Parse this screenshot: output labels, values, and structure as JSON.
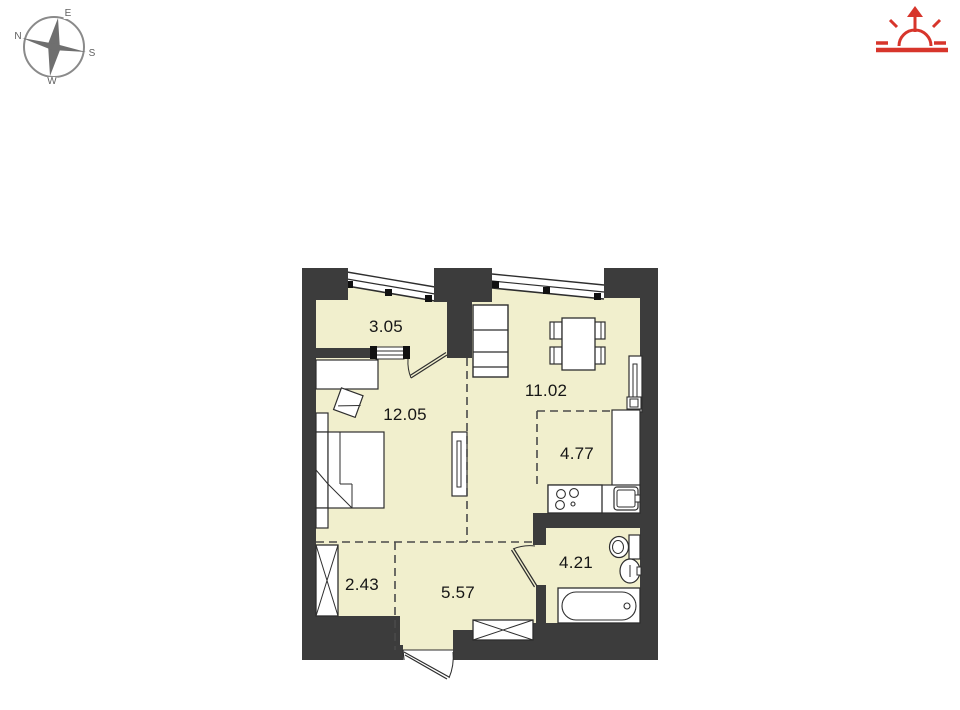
{
  "compass": {
    "north": "N",
    "east": "E",
    "south": "S",
    "west": "W"
  },
  "header": {
    "icons": [
      {
        "name": "compass-rose",
        "color": "#6f6f6f"
      },
      {
        "name": "sunrise-arrow-icon",
        "color": "#d7352b"
      }
    ]
  },
  "floor_plan": {
    "rooms": [
      {
        "name": "loggia",
        "area": "3.05"
      },
      {
        "name": "bedroom",
        "area": "12.05"
      },
      {
        "name": "living-room",
        "area": "11.02"
      },
      {
        "name": "kitchen",
        "area": "4.77"
      },
      {
        "name": "bathroom",
        "area": "4.21"
      },
      {
        "name": "closet",
        "area": "2.43"
      },
      {
        "name": "hallway",
        "area": "5.57"
      }
    ],
    "furniture": [
      "bed",
      "desk",
      "chair",
      "shelf-unit",
      "dining-table",
      "chairs",
      "radiator",
      "column-radiator",
      "stove",
      "kitchen-counter",
      "kitchen-sink",
      "toilet",
      "wash-basin",
      "bathtub",
      "wardrobe-crossed",
      "entry-cabinet-crossed"
    ],
    "colors": {
      "wall": "#3c3c3c",
      "floor": "#f1efcd",
      "outline": "#2e2e2e",
      "dashed": "#4a4a4a"
    }
  }
}
